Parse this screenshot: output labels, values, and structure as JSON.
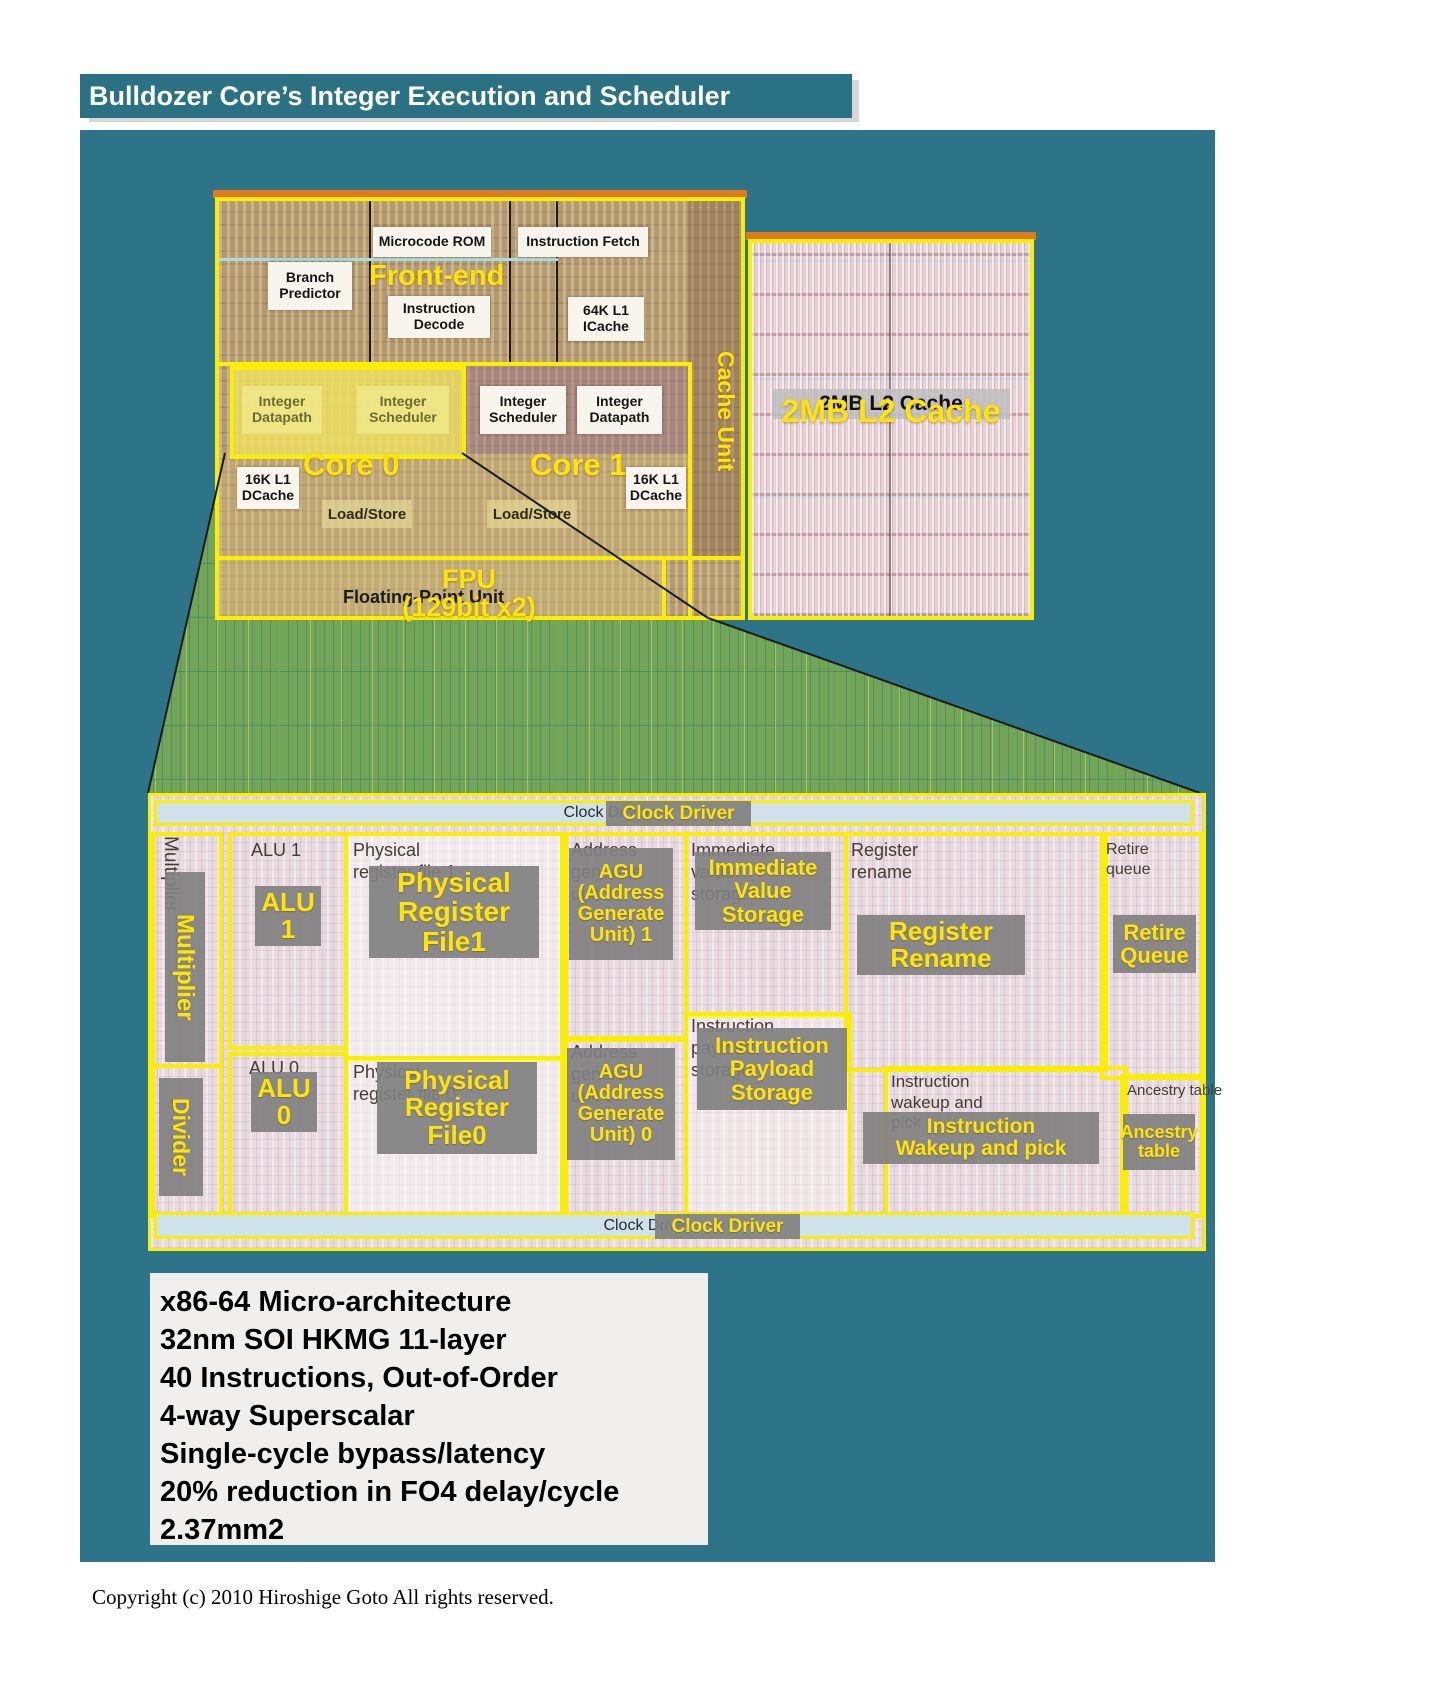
{
  "title": "Bulldozer Core’s Integer Execution and Scheduler",
  "colors": {
    "background_teal": "#2d7488",
    "accent_yellow": "#fde40a",
    "border_yellow": "#fbee00",
    "overlay_green": "#72a557",
    "label_gray": "#808080",
    "info_box_bg": "#f0efed"
  },
  "die_overview": {
    "front_end": {
      "overlay": "Front-end",
      "microcode_rom": "Microcode ROM",
      "instruction_fetch": "Instruction Fetch",
      "branch_predictor": "Branch\nPredictor",
      "instruction_decode": "Instruction\nDecode",
      "l1_icache": "64K L1\nICache"
    },
    "core0": {
      "overlay": "Core 0",
      "integer_datapath": "Integer\nDatapath",
      "integer_scheduler": "Integer\nScheduler",
      "dcache": "16K L1\nDCache",
      "load_store": "Load/Store"
    },
    "core1": {
      "overlay": "Core 1",
      "integer_scheduler": "Integer\nScheduler",
      "integer_datapath": "Integer\nDatapath",
      "dcache": "16K L1\nDCache",
      "load_store": "Load/Store"
    },
    "cache_unit": {
      "overlay": "Cache Unit"
    },
    "l2_cache": {
      "base": "2MB L2 Cache",
      "overlay": "2MB L2 Cache"
    },
    "fpu": {
      "base": "Floating-Point Unit",
      "overlay": "FPU\n(129bit x2)"
    }
  },
  "zoom_panel": {
    "clock_driver_top": {
      "base": "Clock Driver",
      "overlay": "Clock Driver"
    },
    "clock_driver_bottom": {
      "base": "Clock Driver",
      "overlay": "Clock Driver"
    },
    "multiplier": {
      "base": "Multiplier",
      "overlay": "Multiplier"
    },
    "divider": {
      "overlay": "Divider"
    },
    "alu1": {
      "base": "ALU 1",
      "overlay": "ALU\n1"
    },
    "alu0": {
      "base": "ALU 0",
      "overlay": "ALU\n0"
    },
    "prf1": {
      "base": "Physical\nregister file 1",
      "overlay": "Physical\nRegister\nFile1"
    },
    "prf0": {
      "base": "Physical\nregister file 0",
      "overlay": "Physical\nRegister\nFile0"
    },
    "agu1": {
      "base": "Address\ngenerate\nunit 1",
      "overlay": "AGU\n(Address\nGenerate\nUnit) 1"
    },
    "agu0": {
      "base": "Address\ngenerate\nunit 0",
      "overlay": "AGU\n(Address\nGenerate\nUnit) 0"
    },
    "immediate": {
      "base": "Immediate\nvalue\nstorage",
      "overlay": "Immediate\nValue\nStorage"
    },
    "payload": {
      "base": "Instruction\npayload\nstorage",
      "overlay": "Instruction\nPayload\nStorage"
    },
    "rename": {
      "base": "Register\nrename",
      "overlay": "Register\nRename"
    },
    "retire": {
      "base": "Retire\nqueue",
      "overlay": "Retire\nQueue"
    },
    "wakeup": {
      "base": "Instruction\nwakeup and\npick",
      "overlay": "Instruction\nWakeup and pick"
    },
    "ancestry": {
      "base": "Ancestry table",
      "overlay": "Ancestry\ntable"
    }
  },
  "specs": {
    "lines": [
      "x86-64 Micro-architecture",
      "32nm SOI HKMG 11-layer",
      "40 Instructions, Out-of-Order",
      "4-way Superscalar",
      "Single-cycle bypass/latency",
      "20% reduction in FO4 delay/cycle",
      "2.37mm2"
    ]
  },
  "copyright": "Copyright (c) 2010 Hiroshige Goto All rights reserved."
}
